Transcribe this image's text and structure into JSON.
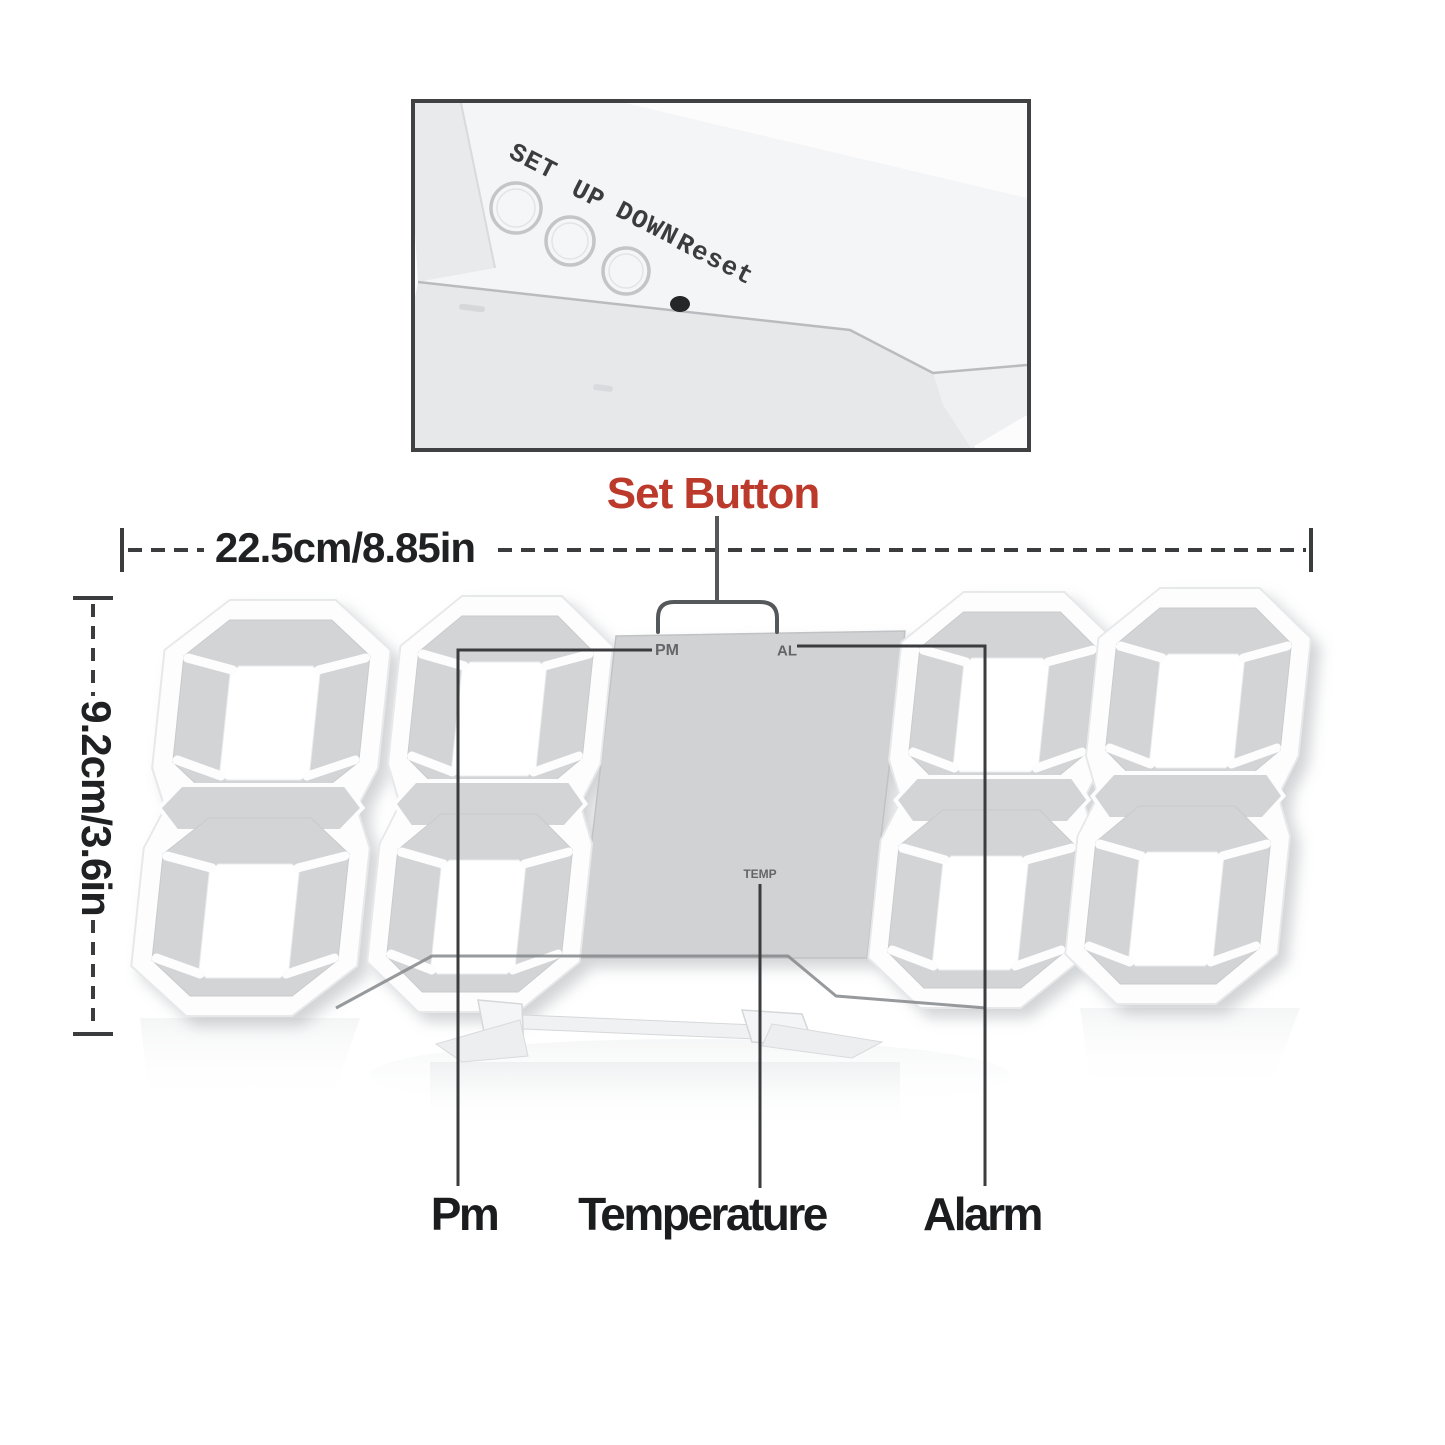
{
  "inset_photo": {
    "set": "SET",
    "up": "UP",
    "down": "DOWN",
    "reset": "Reset"
  },
  "pointer": {
    "set_button": "Set Button"
  },
  "dimensions": {
    "width": "22.5cm/8.85in",
    "height": "9.2cm/3.6in"
  },
  "display_markings": {
    "pm": "PM",
    "alarm": "AL",
    "temperature": "TEMP"
  },
  "callout_labels": {
    "pm": "Pm",
    "temperature": "Temperature",
    "alarm": "Alarm"
  },
  "colors": {
    "accent_red": "#bc3a2c",
    "annotation_line": "#3a3c3e",
    "segment_gray": "#d2d4d6",
    "frame_white": "#fdfdfe",
    "panel_gray": "#d0d2d4"
  }
}
